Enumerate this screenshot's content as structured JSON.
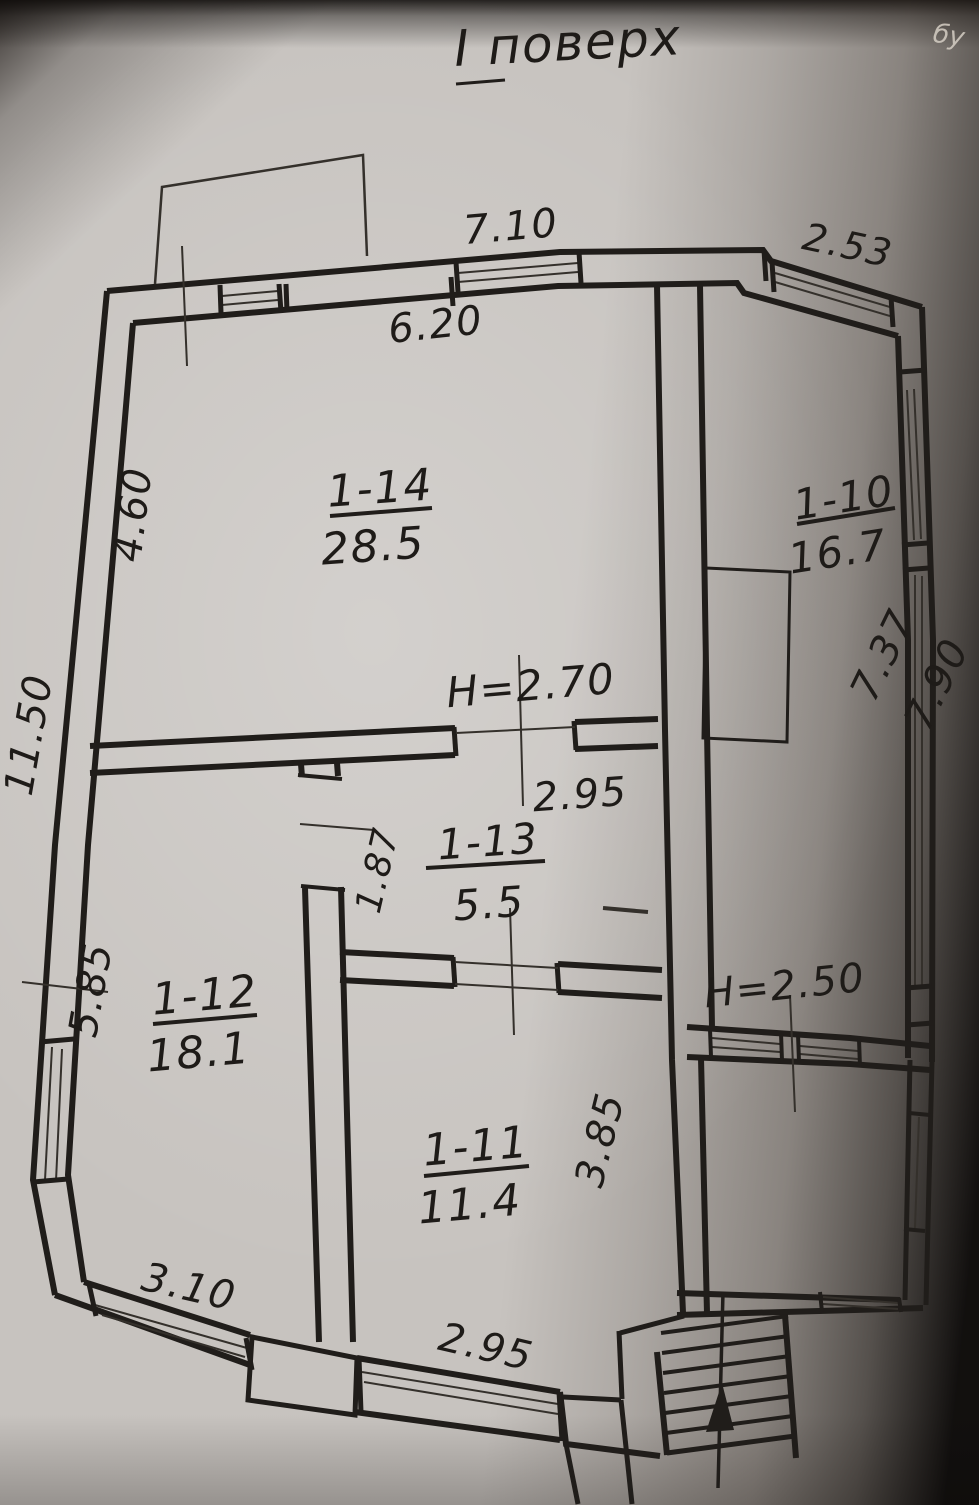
{
  "page": {
    "title": "І поверх",
    "corner_fragment": "бу"
  },
  "style": {
    "ink_color": "#201d1a",
    "paper_color": "#c7c3bf"
  },
  "plan": {
    "rooms": [
      {
        "id": "1-14",
        "area": "28.5"
      },
      {
        "id": "1-10",
        "area": "16.7"
      },
      {
        "id": "1-13",
        "area": "5.5"
      },
      {
        "id": "1-12",
        "area": "18.1"
      },
      {
        "id": "1-11",
        "area": "11.4"
      }
    ],
    "ceiling_heights": [
      {
        "label": "Н=2.70"
      },
      {
        "label": "Н=2.50"
      }
    ],
    "dimensions": {
      "top_wall": "7.10",
      "top_right_wall": "2.53",
      "room_1_14_width": "6.20",
      "room_1_14_left": "4.60",
      "left_wall_total": "11.50",
      "room_1_12_left": "5.85",
      "hall_1_13_depth": "1.87",
      "hall_1_13_width": "2.95",
      "room_1_11_depth": "3.85",
      "bottom_left_window": "3.10",
      "bottom_window": "2.95",
      "right_wall_inner": "7.37",
      "right_wall_outer": "7.90"
    }
  }
}
